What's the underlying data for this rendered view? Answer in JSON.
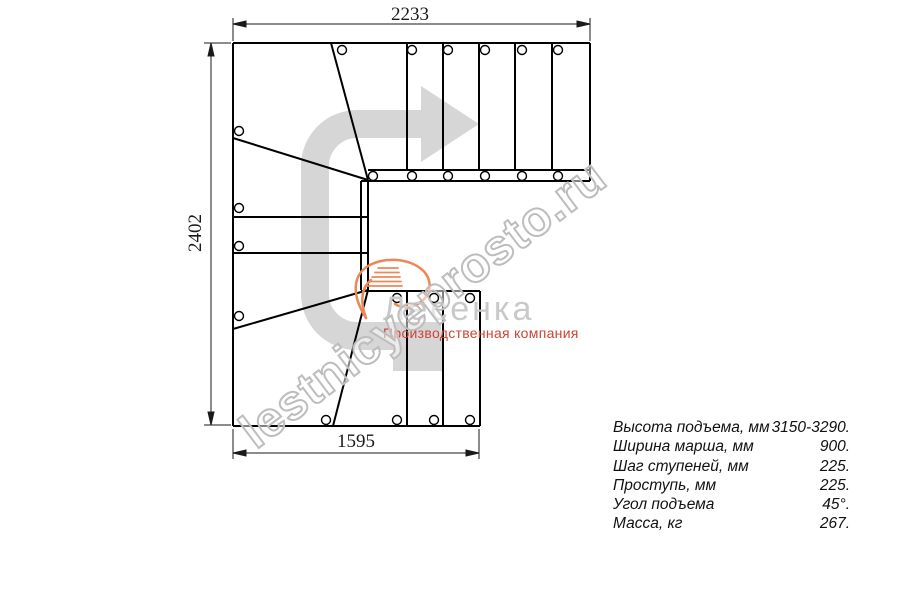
{
  "drawing": {
    "title": "stair-plan-top-view",
    "dim_top": "2233",
    "dim_left": "2402",
    "dim_bottom": "1595",
    "line_color": "#000000",
    "arrow_color": "#d6d6d6"
  },
  "watermark": {
    "text": "lestnicyeprosto.ru",
    "color": "#bdbdbd"
  },
  "logo": {
    "name": "Лесенка",
    "tagline": "Производственная компания",
    "name_color": "#c9c9c9",
    "tagline_color": "#cc4433",
    "flame_color": "#ee8757"
  },
  "specs": {
    "rows": [
      {
        "label": "Высота подъема, мм",
        "value": "3150-3290."
      },
      {
        "label": "Ширина марша, мм",
        "value": "900."
      },
      {
        "label": "Шаг ступеней, мм",
        "value": "225."
      },
      {
        "label": "Проступь, мм",
        "value": "225."
      },
      {
        "label": "Угол подъема",
        "value": "45°."
      },
      {
        "label": "Масса, кг",
        "value": "267."
      }
    ]
  }
}
